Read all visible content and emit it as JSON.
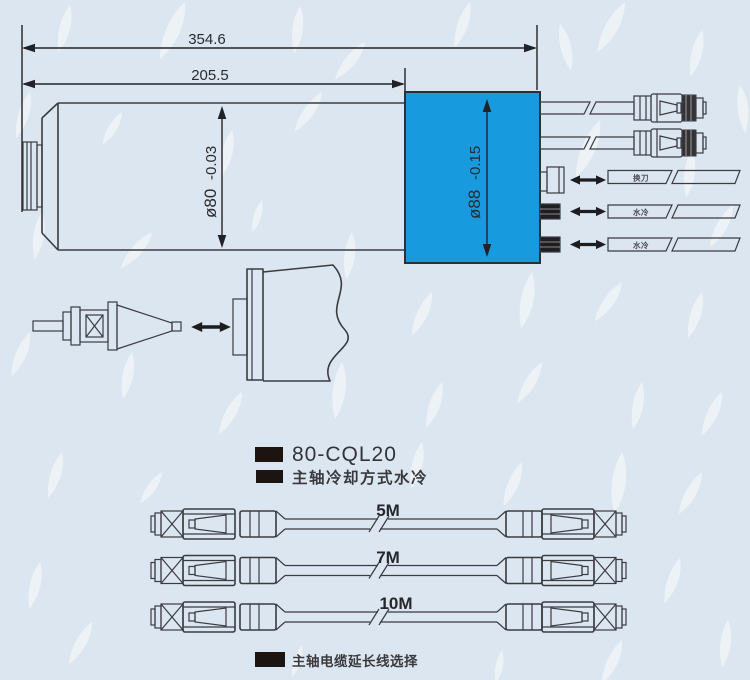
{
  "colors": {
    "background": "#dbe6f0",
    "block_blue": "#189ade",
    "bullet_black": "#1c1410",
    "port_white": "#f6f8fa"
  },
  "dimensions": {
    "overall_length": "354.6",
    "body_length": "205.5",
    "body_diameter": "ø80",
    "body_diameter_tolerance": "-0.03",
    "rear_diameter": "ø88",
    "rear_diameter_tolerance": "-0.15"
  },
  "ports": [
    {
      "label": "换刀"
    },
    {
      "label": "水冷"
    },
    {
      "label": "水冷"
    }
  ],
  "captions": {
    "model": "80-CQL20",
    "cooling": "主轴冷却方式水冷",
    "cable_note": "主轴电缆延长线选择"
  },
  "cables": [
    {
      "length": "5M"
    },
    {
      "length": "7M"
    },
    {
      "length": "10M"
    }
  ]
}
